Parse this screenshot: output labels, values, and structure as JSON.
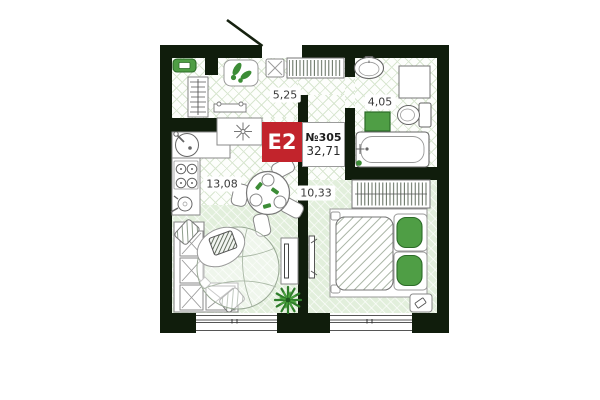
{
  "badge": {
    "layout_type": "E2",
    "unit_number": "№305",
    "total_area": "32,71"
  },
  "rooms": [
    {
      "id": "hallway",
      "area": "5,25"
    },
    {
      "id": "bathroom",
      "area": "4,05"
    },
    {
      "id": "kitchen_living_room",
      "area": "13,08"
    },
    {
      "id": "bedroom",
      "area": "10,33"
    }
  ],
  "colors": {
    "wall": "#101d0c",
    "badge_red": "#c2242c",
    "furniture_green": "#4f9e45",
    "furniture_green_border": "#2c6b28",
    "tile_line": "#d8e6d0",
    "laminate": "#e2efdc"
  },
  "icons": [
    "entrance-door",
    "entry-bench",
    "coat-rack",
    "shoe-mat",
    "console-shelf",
    "stool",
    "hallway-closet",
    "kitchen-sink",
    "cooktop-symbol",
    "stove",
    "kettle",
    "dining-table",
    "dining-chair",
    "corner-sofa",
    "sofa-pillow",
    "rug",
    "pouf",
    "laptop",
    "plant",
    "tv-stand",
    "wall-tv",
    "bathroom-sink",
    "bathroom-cabinet",
    "toilet",
    "washing-machine",
    "bathtub",
    "wardrobe",
    "double-bed",
    "bed-pillow",
    "nightstand",
    "window"
  ]
}
